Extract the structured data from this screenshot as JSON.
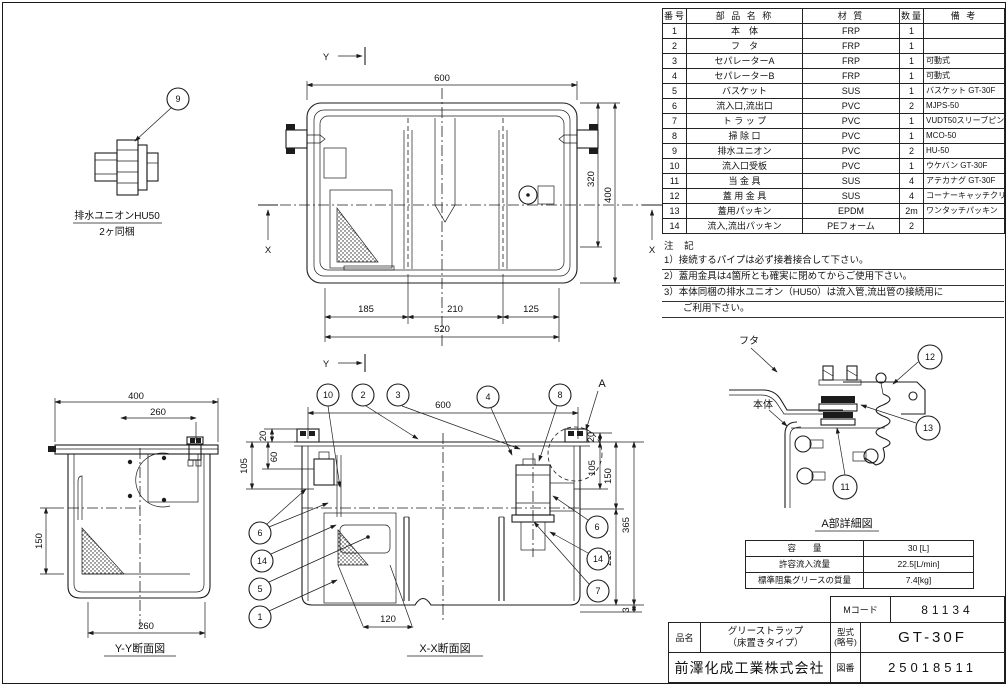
{
  "parts_table": {
    "headers": [
      "番号",
      "部 品 名 称",
      "材 質",
      "数量",
      "備  考"
    ],
    "rows": [
      [
        "1",
        "本　体",
        "FRP",
        "1",
        ""
      ],
      [
        "2",
        "フ　タ",
        "FRP",
        "1",
        ""
      ],
      [
        "3",
        "セパレーターA",
        "FRP",
        "1",
        "可動式"
      ],
      [
        "4",
        "セパレーターB",
        "FRP",
        "1",
        "可動式"
      ],
      [
        "5",
        "バスケット",
        "SUS",
        "1",
        "バスケット GT-30F"
      ],
      [
        "6",
        "流入口,流出口",
        "PVC",
        "2",
        "MJPS-50"
      ],
      [
        "7",
        "ト ラ ッ プ",
        "PVC",
        "1",
        "VUDT50スリーブピン"
      ],
      [
        "8",
        "掃 除 口",
        "PVC",
        "1",
        "MCO-50"
      ],
      [
        "9",
        "排水ユニオン",
        "PVC",
        "2",
        "HU-50"
      ],
      [
        "10",
        "流入口受板",
        "PVC",
        "1",
        "ウケバン GT-30F"
      ],
      [
        "11",
        "当 金 具",
        "SUS",
        "4",
        "アテカナグ GT-30F"
      ],
      [
        "12",
        "蓋 用 金 具",
        "SUS",
        "4",
        "コーナーキャッチクリップ"
      ],
      [
        "13",
        "蓋用パッキン",
        "EPDM",
        "2m",
        "ワンタッチパッキン"
      ],
      [
        "14",
        "流入,流出パッキン",
        "PEフォーム",
        "2",
        ""
      ]
    ]
  },
  "notes": {
    "title": "注 記",
    "lines": [
      "1）接続するパイプは必ず接着接合して下さい。",
      "2）蓋用金具は4箇所とも確実に閉めてからご使用下さい。",
      "3）本体同梱の排水ユニオン（HU50）は流入管,流出管の接続用に",
      "　　ご利用下さい。"
    ]
  },
  "spec_table": {
    "rows": [
      {
        "label": "容　　量",
        "value": "30  [L]"
      },
      {
        "label": "許容流入流量",
        "value": "22.5[L/min]"
      },
      {
        "label": "標準阻集グリースの質量",
        "value": "7.4[kg]"
      }
    ]
  },
  "title_block": {
    "m_code_label": "Mコード",
    "m_code": "81134",
    "part_name_label": "品名",
    "part_name_line1": "グリーストラップ",
    "part_name_line2": "（床置きタイプ）",
    "model_label_line1": "型式",
    "model_label_line2": "(略号)",
    "model": "GT-30F",
    "company": "前澤化成工業株式会社",
    "drawing_no_label": "図番",
    "drawing_no": "25018511"
  },
  "union_detail": {
    "balloon": "9",
    "label_line1": "排水ユニオンHU50",
    "label_line2": "2ヶ同梱"
  },
  "plan_view": {
    "marker_y": "Y",
    "marker_x": "X",
    "dim_width": "600",
    "dim_depth_inner": "320",
    "dim_depth": "400",
    "dim_seg1": "185",
    "dim_seg2": "210",
    "dim_seg3": "125",
    "dim_total": "520"
  },
  "yy_section": {
    "caption": "Y-Y断面図",
    "dim_top": "400",
    "dim_top2": "260",
    "dim_left": "150",
    "dim_bottom": "260"
  },
  "xx_section": {
    "caption": "X-X断面図",
    "dim_width": "600",
    "detail_mark": "A",
    "dims_left": [
      "20",
      "60",
      "105"
    ],
    "dims_right": [
      "20",
      "105",
      "150",
      "365",
      "215",
      "3"
    ],
    "dim_bottom": "120",
    "balloons_top": [
      "10",
      "2",
      "3",
      "4",
      "8"
    ],
    "balloons_left": [
      "6",
      "14",
      "5",
      "1"
    ],
    "balloons_right": [
      "6",
      "14",
      "7"
    ]
  },
  "detail_a": {
    "caption": "A部詳細図",
    "label_lid": "フタ",
    "label_body": "本体",
    "balloons": [
      "12",
      "13",
      "11"
    ]
  }
}
